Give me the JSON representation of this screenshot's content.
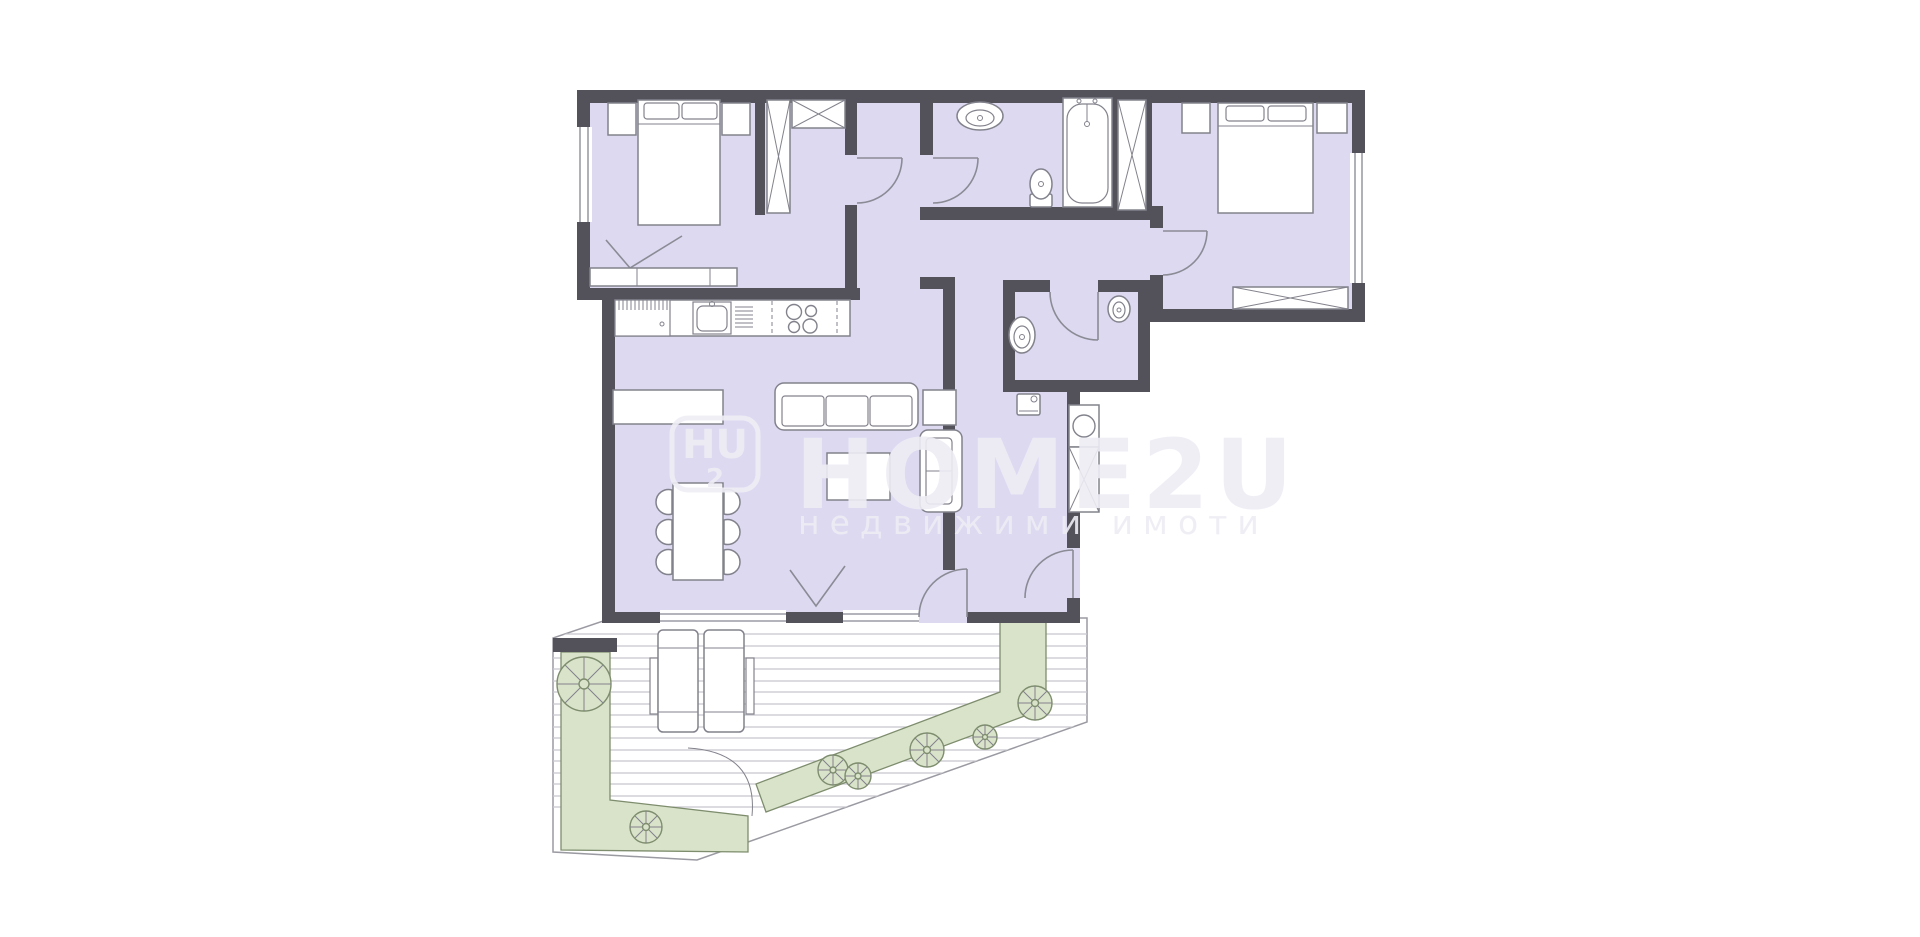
{
  "palette": {
    "background": "#ffffff",
    "room_fill": "#dcd9f1",
    "wall": "#53525a",
    "outline": "#82828c",
    "terrace_green": "#d9e3ca",
    "green_outline": "#7e8d6d",
    "deck_line": "#c7c7cd",
    "watermark": "#eeedf5"
  },
  "watermark": {
    "logo_letters": "HU",
    "logo_number": "2",
    "brand": "HOME2U",
    "tagline": "недвижими имоти"
  },
  "plan": {
    "type": "apartment-floor-plan",
    "rooms": [
      {
        "name": "bedroom-1",
        "position": "top-left",
        "furniture": [
          "double-bed",
          "two-nightstands",
          "tall-wardrobe",
          "top-wardrobe",
          "sideboard",
          "window-marker"
        ]
      },
      {
        "name": "entry-hall",
        "position": "top-center",
        "furniture": [
          "bedroom-door",
          "bathroom-door"
        ]
      },
      {
        "name": "bathroom",
        "position": "top-right-center",
        "furniture": [
          "washbasin",
          "toilet",
          "bathtub"
        ]
      },
      {
        "name": "shaft-wardrobe",
        "position": "between-bathroom-and-bedroom-2",
        "furniture": [
          "x-wardrobe"
        ]
      },
      {
        "name": "bedroom-2",
        "position": "top-right",
        "furniture": [
          "double-bed",
          "two-nightstands",
          "bottom-wardrobe",
          "right-window"
        ]
      },
      {
        "name": "wc",
        "position": "center-right",
        "furniture": [
          "washbasin",
          "corner-basin",
          "boiler"
        ]
      },
      {
        "name": "hallway",
        "position": "right",
        "furniture": [
          "service-shaft",
          "entrance-door"
        ]
      },
      {
        "name": "living-room-with-kitchen",
        "position": "center-left",
        "furniture": [
          "kitchen-counter",
          "kitchen-sink",
          "cooktop",
          "tv-console",
          "sofa",
          "side-table",
          "armchair",
          "coffee-table",
          "dining-table",
          "six-chairs",
          "terrace-door",
          "window-marker"
        ]
      },
      {
        "name": "terrace",
        "position": "bottom",
        "furniture": [
          "wood-deck",
          "two-sun-loungers",
          "left-planter",
          "diagonal-planter",
          "six-trees"
        ]
      }
    ]
  }
}
